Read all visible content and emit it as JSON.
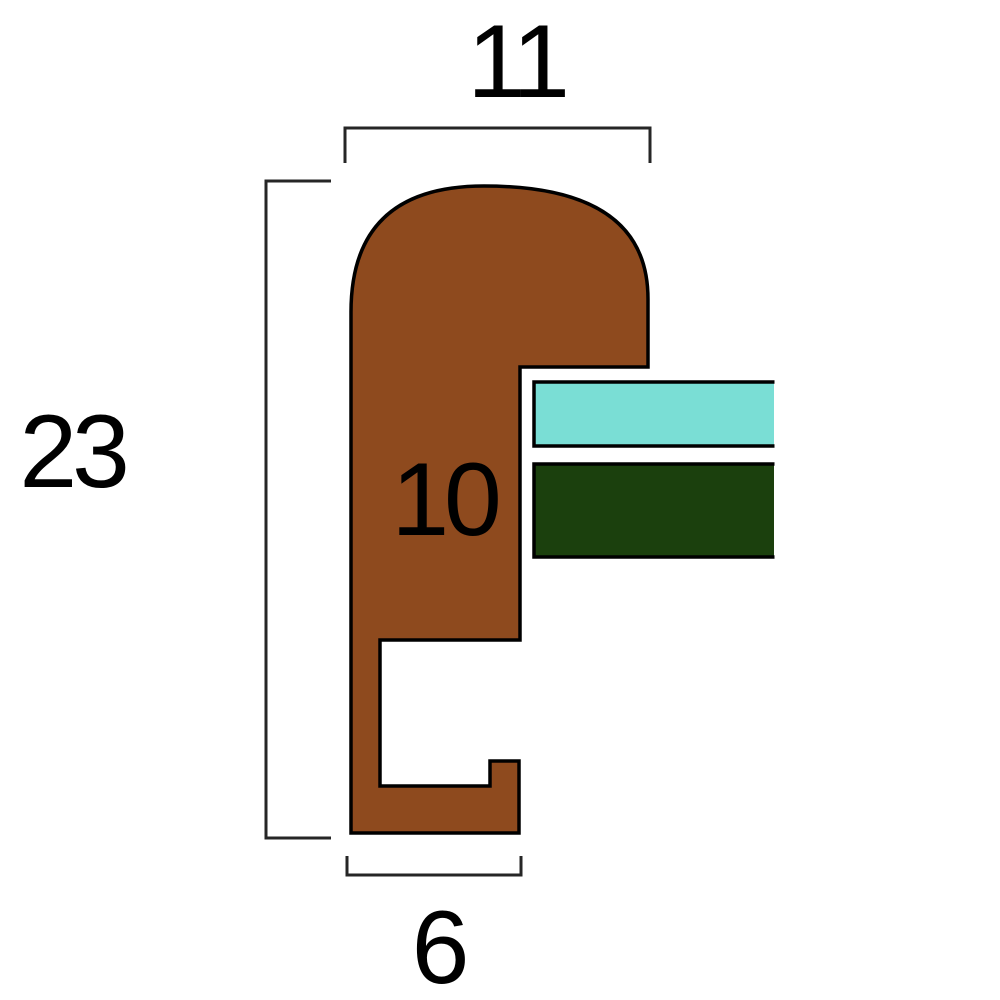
{
  "diagram": {
    "kind": "frame-moulding-cross-section",
    "labels": {
      "top_width": "11",
      "overall_height": "23",
      "rabbet_opening": "10",
      "bottom_width": "6"
    },
    "colors": {
      "moulding": "#8E4A1E",
      "glass": "#7ADED5",
      "backboard": "#1B400D",
      "outline": "#000000",
      "dimension_line": "#262626",
      "background": "#FFFFFF"
    }
  }
}
